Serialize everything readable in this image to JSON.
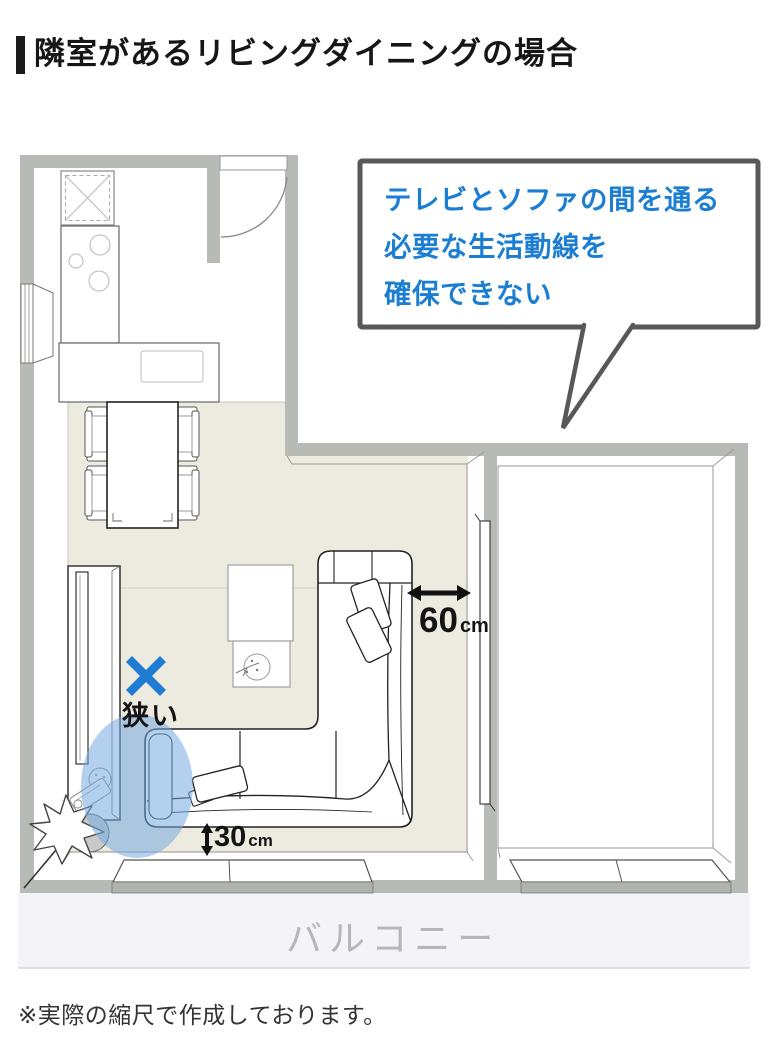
{
  "header": {
    "title": "隣室があるリビングダイニングの場合"
  },
  "footnote": "※実際の縮尺で作成しております。",
  "floor_plan": {
    "callout": {
      "lines": [
        "テレビとソファの間を通る",
        "必要な生活動線を",
        "確保できない"
      ]
    },
    "labels": {
      "balcony": "バルコニー",
      "narrow": "狭い",
      "narrow_mark": "✕"
    },
    "annotations": {
      "tv_wall_gap": {
        "value": "60",
        "unit": "cm"
      },
      "sofa_window_gap": {
        "value": "30",
        "unit": "cm"
      }
    },
    "colors": {
      "wall": "#b8bab6",
      "ld_floor": "#edebe0",
      "accent_blue": "#1b7ed3",
      "highlight_ellipse": "rgba(116,169,224,0.55)",
      "bubble_border": "#57585a",
      "balcony_bg": "#f4f4f8",
      "balcony_text": "#b6b6b9"
    }
  }
}
